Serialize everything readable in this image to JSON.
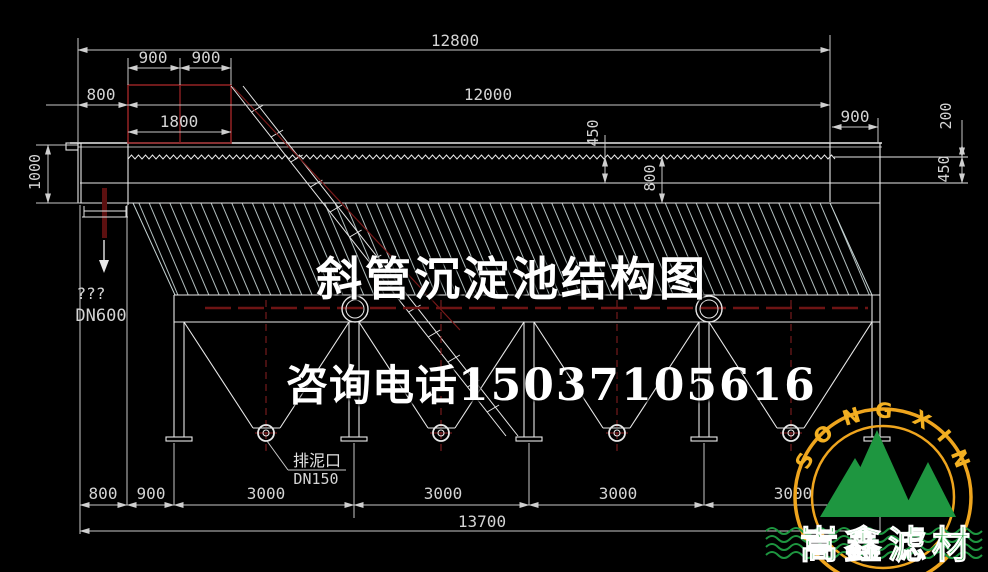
{
  "title": "斜管沉淀池结构图",
  "contact": {
    "label": "咨询电话",
    "phone": "15037105616"
  },
  "dims": {
    "total_top": "12800",
    "box_left": "900",
    "box_right": "900",
    "freeboard": "800",
    "box_width": "1800",
    "inner_length": "12000",
    "outlet_width": "900",
    "outlet_depth": "200",
    "right_450": "450",
    "mid_450": "450",
    "mid_800": "800",
    "left_depth": "1000",
    "b_800": "800",
    "b_900": "900",
    "b_3000_1": "3000",
    "b_3000_2": "3000",
    "b_3000_3": "3000",
    "b_3000_4": "3000",
    "total_bottom": "13700"
  },
  "labels": {
    "inlet_marks": "???",
    "inlet_dn": "DN600",
    "sludge_outlet": "排泥口",
    "sludge_dn": "DN150"
  },
  "logo": {
    "arc_left": "SONG",
    "arc_right": "XIN",
    "company": "嵩鑫滤材"
  },
  "colors": {
    "background": "#000000",
    "line": "#e8e8e8",
    "dim": "#c9c9c9",
    "red": "#8c2022",
    "hatch": "#c6d4d4",
    "logo_ring": "#efa51e",
    "logo_green": "#1e9640"
  }
}
